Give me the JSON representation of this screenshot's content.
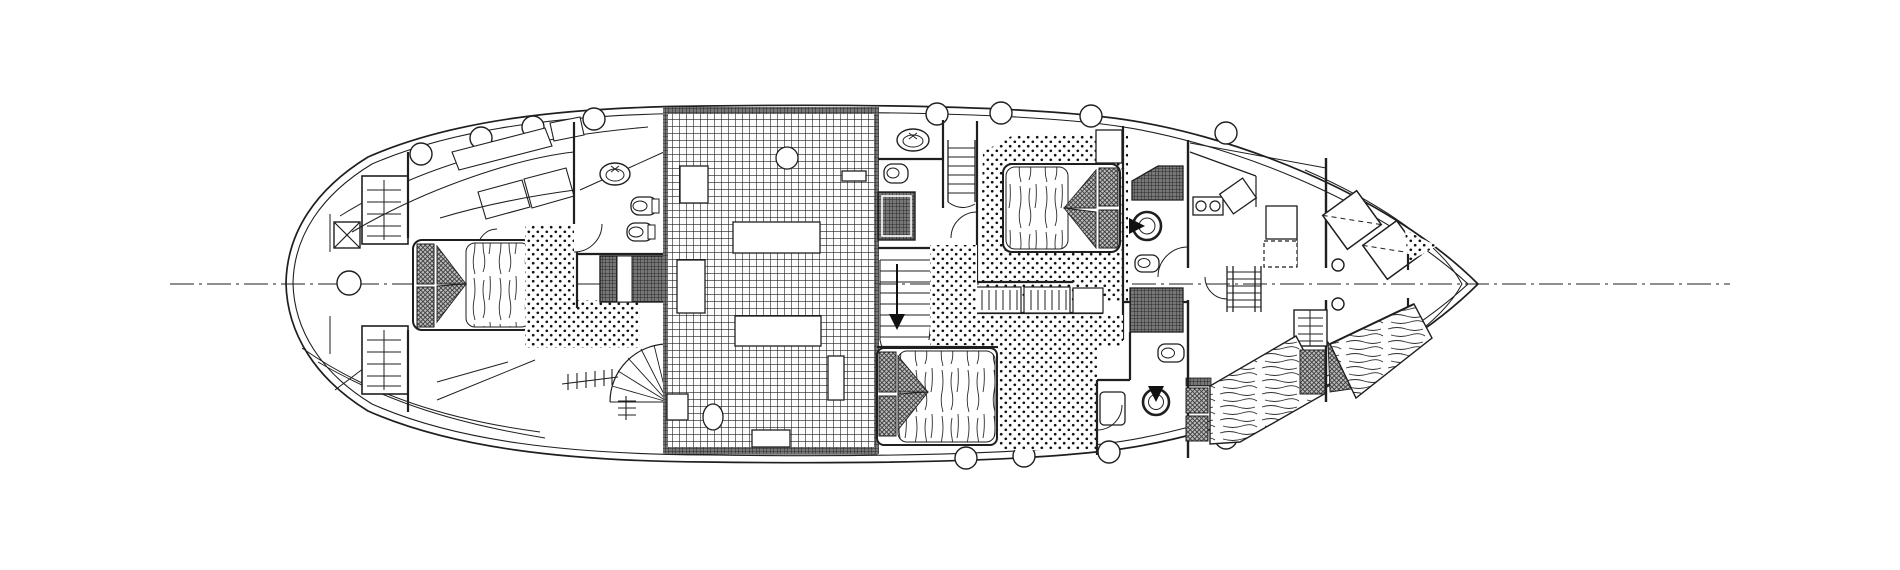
{
  "meta": {
    "title": "Yacht accommodation deck plan - black and white architectural line drawing, top view, bow pointing right, rounded stern left",
    "drawing_type": "boat floor plan",
    "canvas": {
      "width": 1900,
      "height": 570
    }
  },
  "colors": {
    "paper": "#ffffff",
    "ink": "#1f1f1f",
    "locker_fill": "#787878",
    "pillow_fill": "#b9b9b9"
  },
  "plan": {
    "centerline_style": "dash-dot horizontal axis through hull",
    "porthole_count_top": 8,
    "porthole_count_bottom": 4,
    "deck_hatch_count": 2,
    "cabins": [
      {
        "name": "owner-cabin-forward",
        "features": [
          "double-bed-with-two-pillows",
          "shelf-locker-top",
          "shelf-locker-bottom",
          "angled-sofa",
          "cross-marked-locker",
          "windlass-circle"
        ]
      },
      {
        "name": "forward-head",
        "features": [
          "oval-washbasin",
          "toilet",
          "bidet",
          "dark-tiled-shower"
        ]
      },
      {
        "name": "salon",
        "features": [
          "dense-grid-tiled-sole",
          "round-table",
          "rectangular-furniture-blocks",
          "side-shelf"
        ]
      },
      {
        "name": "mid-head",
        "features": [
          "oval-washbasin",
          "toilet",
          "dark-tiled-shower",
          "companionway-stairs-with-down-arrow",
          "deck-ladder"
        ]
      },
      {
        "name": "guest-cabin-upper",
        "features": [
          "double-bed-pillows-right",
          "wardrobe",
          "dotted-carpet-floor",
          "overhead-cabinet"
        ]
      },
      {
        "name": "aft-head-upper",
        "features": [
          "round-washbasin",
          "toilet",
          "wardrobe"
        ]
      },
      {
        "name": "guest-cabin-lower",
        "features": [
          "double-bed-pillows-left",
          "dotted-carpet-floor",
          "settee-with-slats",
          "bedside-cabinet"
        ]
      },
      {
        "name": "aft-head-lower",
        "features": [
          "round-washbasin",
          "toilet"
        ]
      },
      {
        "name": "galley-nav",
        "features": [
          "two-burner-stove",
          "tilted-sink",
          "chart-table",
          "dashed-appliance",
          "companionway-ladder"
        ]
      },
      {
        "name": "aft-deck",
        "features": [
          "two-tilted-deck-hatches-dashed",
          "two-mooring-circles",
          "slatted-shelf",
          "wood-grain-quarter-berths"
        ]
      }
    ]
  }
}
